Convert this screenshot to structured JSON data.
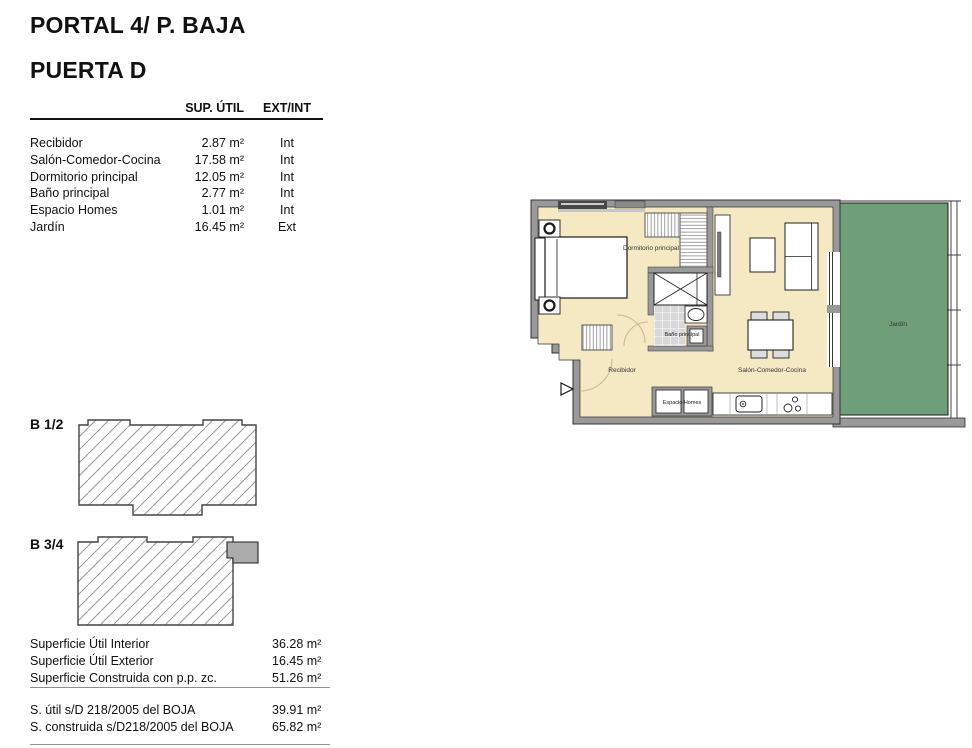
{
  "header": {
    "title1": "PORTAL 4/ P. BAJA",
    "title2": "PUERTA D"
  },
  "table": {
    "headers": {
      "area": "SUP. ÚTIL",
      "ext_int": "EXT/INT"
    },
    "rows": [
      {
        "name": "Recibidor",
        "area": "2.87 m²",
        "type": "Int"
      },
      {
        "name": "Salón-Comedor-Cocina",
        "area": "17.58 m²",
        "type": "Int"
      },
      {
        "name": "Dormitorio principal",
        "area": "12.05 m²",
        "type": "Int"
      },
      {
        "name": "Baño principal",
        "area": "2.77 m²",
        "type": "Int"
      },
      {
        "name": "Espacio Homes",
        "area": "1.01 m²",
        "type": "Int"
      },
      {
        "name": "Jardín",
        "area": "16.45 m²",
        "type": "Ext"
      }
    ]
  },
  "floorplan": {
    "rooms": {
      "dormitorio": "Dormitorio principal",
      "bano": "Baño principal",
      "recibidor": "Recibidor",
      "salon": "Salón-Comedor-Cocina",
      "espacio": "Espacio Homes",
      "jardin": "Jardín"
    },
    "colors": {
      "wall": "#999999",
      "interior": "#F5E9C3",
      "garden": "#6F9F78",
      "tile": "#D8D8D8"
    }
  },
  "key_plans": [
    {
      "label": "B 1/2"
    },
    {
      "label": "B 3/4"
    }
  ],
  "summary": {
    "rows": [
      {
        "label": "Superficie Útil Interior",
        "value": "36.28 m²"
      },
      {
        "label": "Superficie Útil Exterior",
        "value": "16.45 m²"
      },
      {
        "label": "Superficie Construida con p.p. zc.",
        "value": "51.26 m²"
      }
    ],
    "boja_rows": [
      {
        "label": "S. útil s/D 218/2005 del BOJA",
        "value": "39.91 m²"
      },
      {
        "label": "S. construida s/D218/2005 del BOJA",
        "value": "65.82 m²"
      }
    ]
  }
}
